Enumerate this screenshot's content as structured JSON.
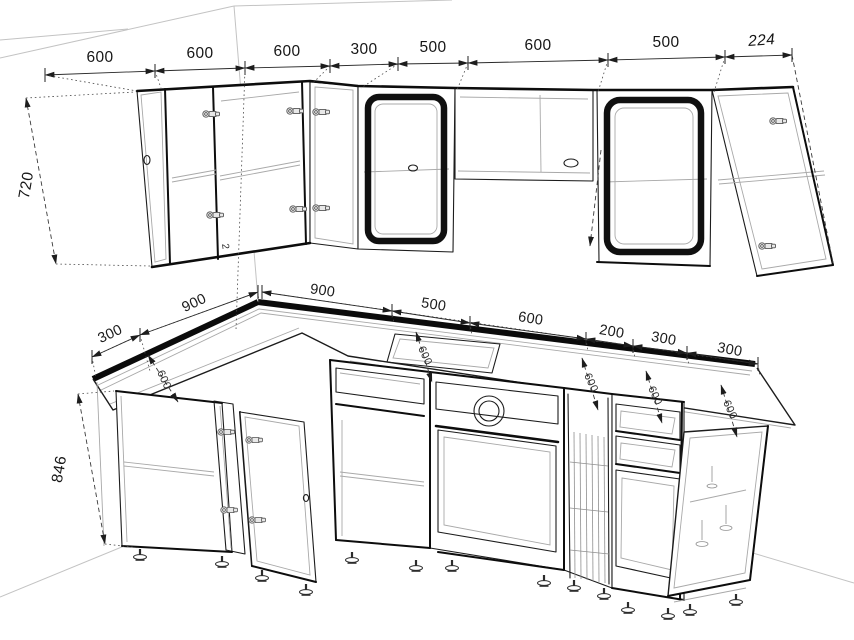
{
  "figure": {
    "palette": {
      "line": "#1c1c1c",
      "heavy_line": "#0d0d0d",
      "light_line": "#a9a9a9",
      "dimension_text": "#161616",
      "background": "#ffffff"
    }
  },
  "dims": {
    "upper_run": [
      "600",
      "600",
      "600",
      "300",
      "500",
      "600",
      "500",
      "224"
    ],
    "upper_height": "720",
    "base_height": "846",
    "counter_left": [
      "300",
      "900"
    ],
    "counter_main": [
      "900",
      "500",
      "600",
      "200",
      "300",
      "300"
    ],
    "depths": [
      "600",
      "600",
      "600",
      "600",
      "600"
    ],
    "hidden_partial": "2"
  }
}
